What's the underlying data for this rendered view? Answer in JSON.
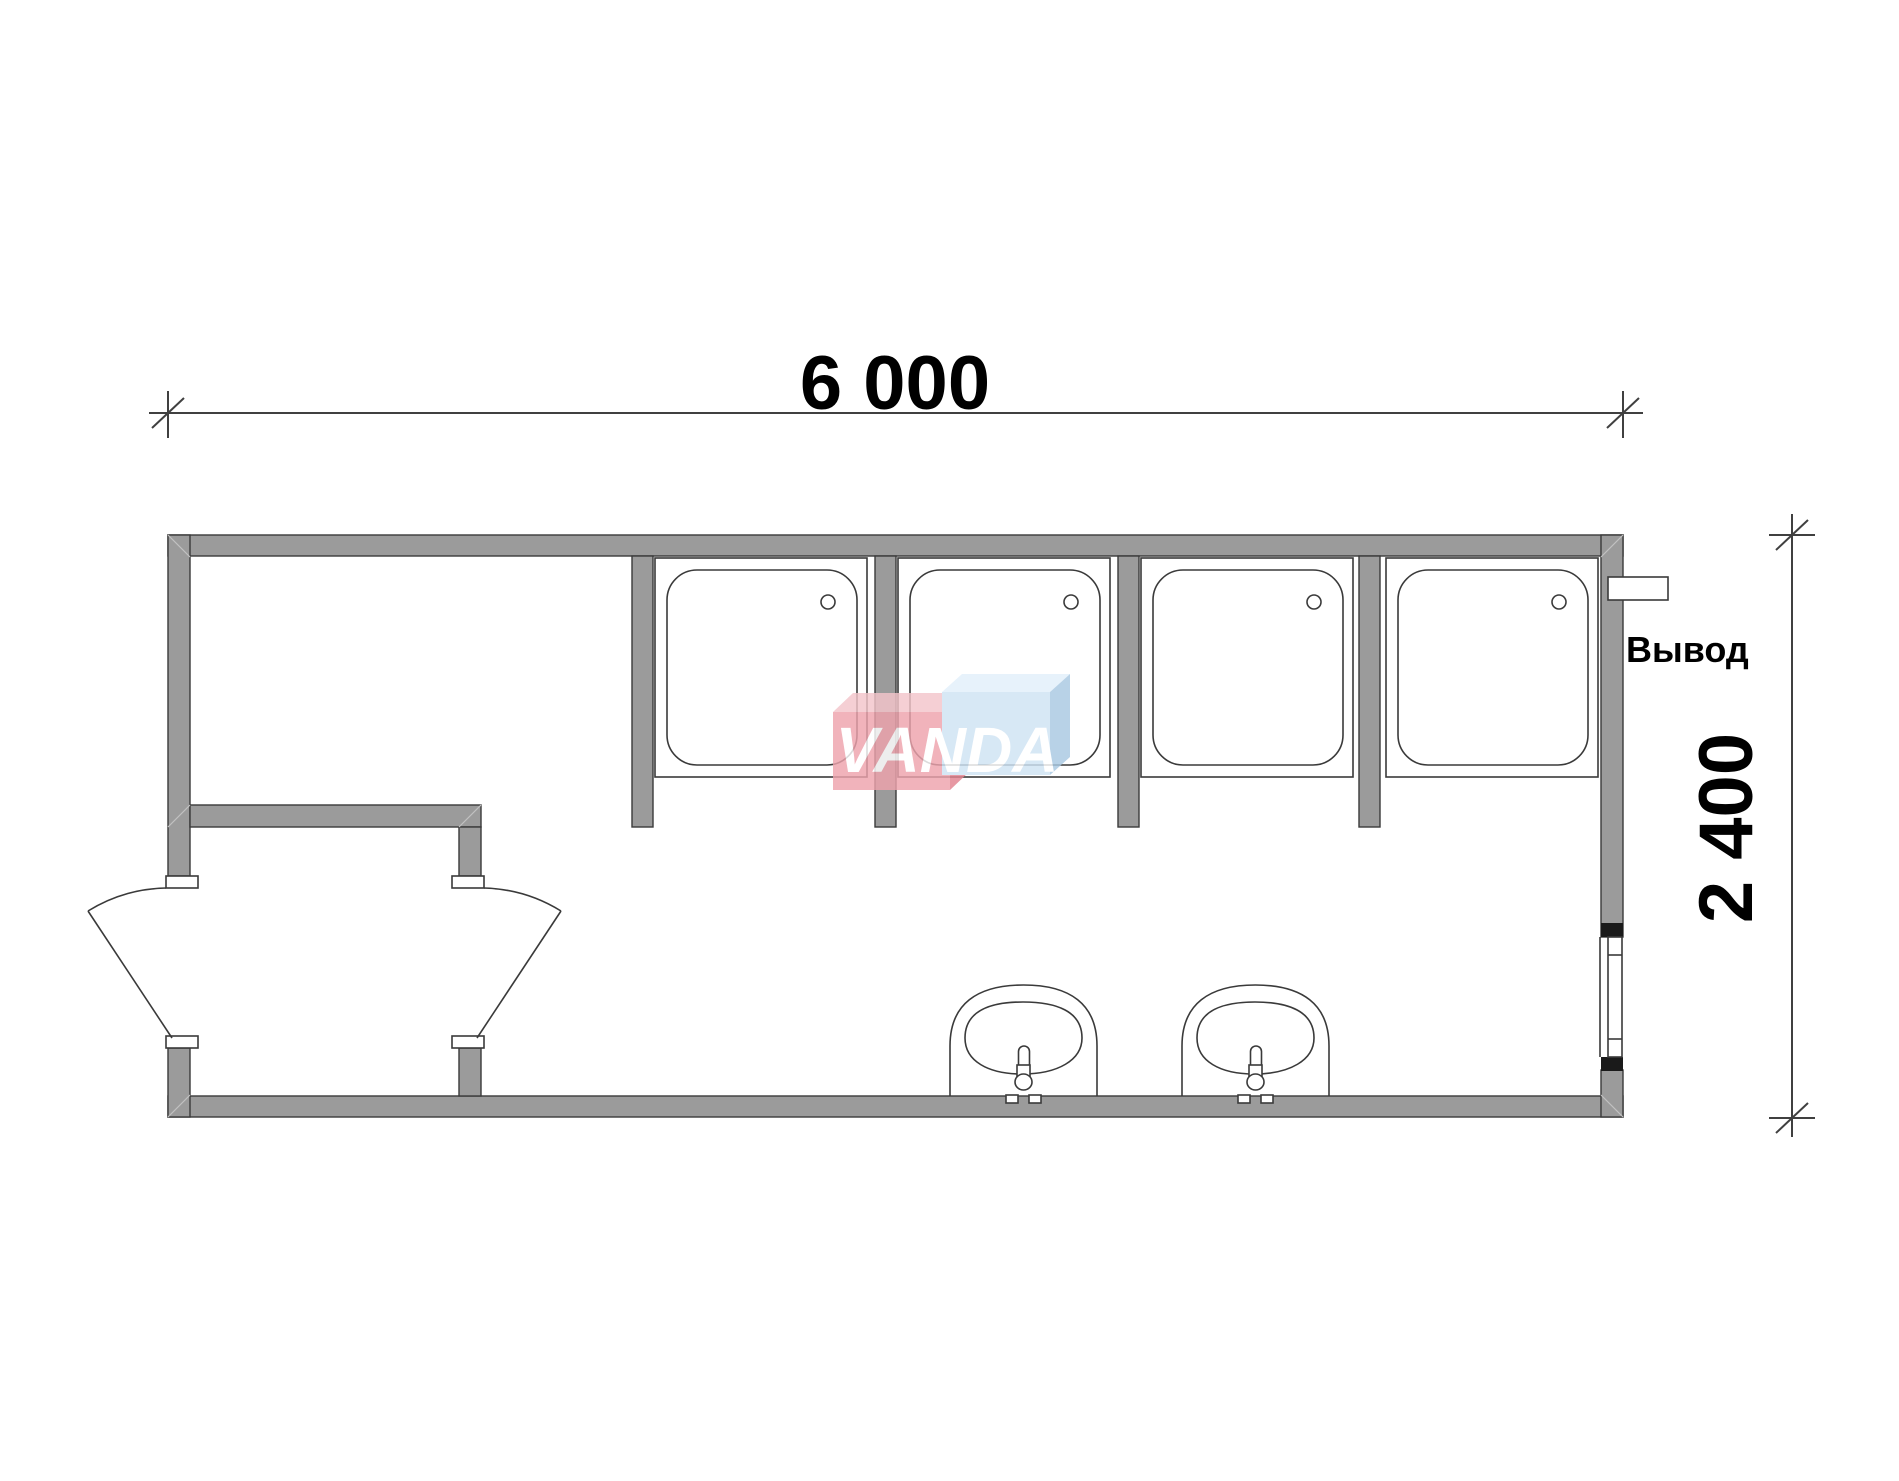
{
  "drawing": {
    "dimensions": {
      "width_mm": "6 000",
      "height_mm": "2 400"
    },
    "annotations": {
      "outlet_label": "Вывод"
    },
    "watermark": {
      "text": "VANDA",
      "pink_front": "#eea3ad",
      "pink_top": "#f4c5cb",
      "pink_side": "#e2828f",
      "blue_front": "#cfe3f4",
      "blue_top": "#e2f0fb",
      "blue_side": "#a9c9e2"
    },
    "colors": {
      "wall_fill": "#9b9b9b",
      "line": "#3a3a3a",
      "background": "#ffffff"
    },
    "fixtures": {
      "shower_trays": 4,
      "washbasins": 2,
      "door_leaves": 2,
      "windows": 1
    }
  }
}
